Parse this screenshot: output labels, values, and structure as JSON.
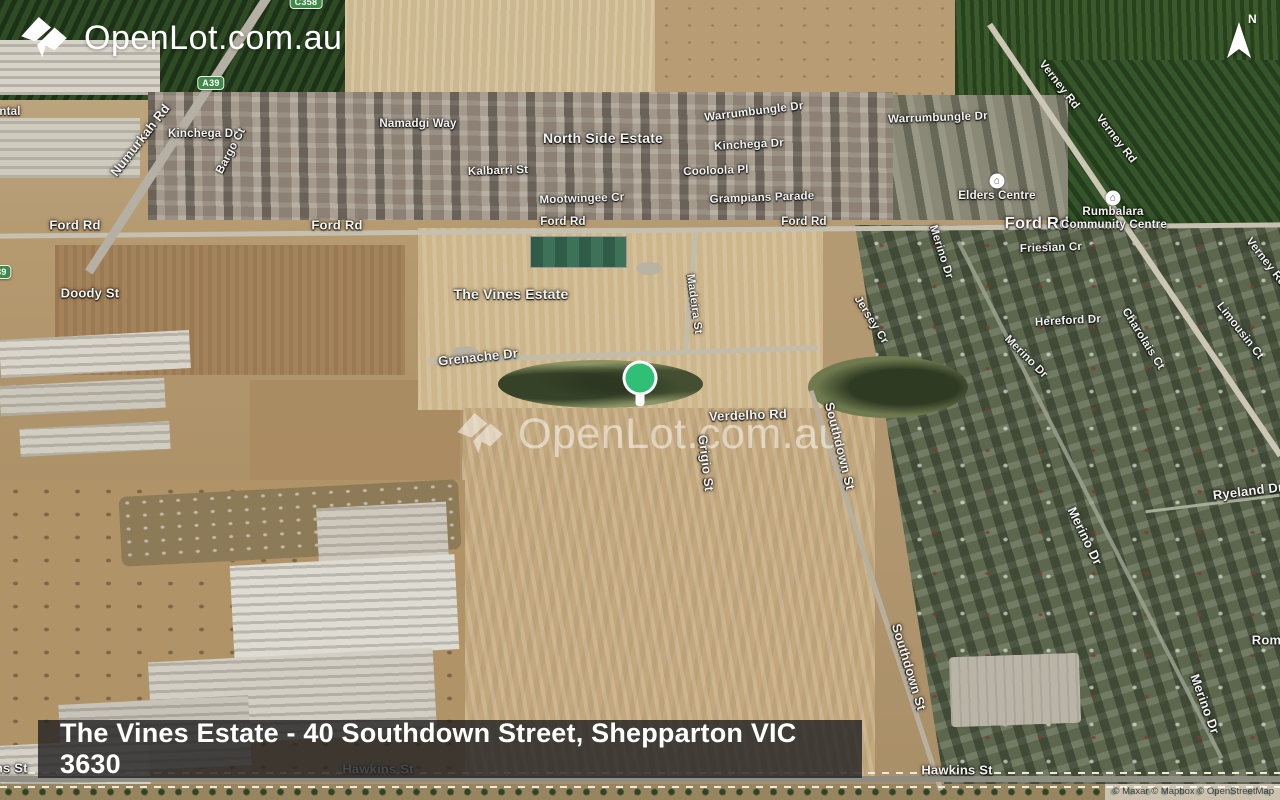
{
  "branding": {
    "logo_text": "OpenLot.com.au",
    "watermark_text": "OpenLot.com.au"
  },
  "compass": {
    "label": "N"
  },
  "pin": {
    "color": "#2fc076"
  },
  "title_bar": {
    "text": "The Vines Estate - 40 Southdown Street, Shepparton VIC 3630"
  },
  "attribution": {
    "text": "© Maxar © Mapbox © OpenStreetMap"
  },
  "colors": {
    "shield_green": "#3d8b47",
    "pin_green": "#2fc076",
    "bar_bg": "rgba(35,35,37,0.82)"
  },
  "map": {
    "shields": [
      {
        "text": "C358",
        "x": 306,
        "y": 2
      },
      {
        "text": "A39",
        "x": 211,
        "y": 83
      },
      {
        "text": "A39",
        "x": -2,
        "y": 272
      }
    ],
    "poi_icons": [
      {
        "name": "building-icon",
        "glyph": "⌂",
        "x": 997,
        "y": 181
      },
      {
        "name": "building-icon",
        "glyph": "⌂",
        "x": 1113,
        "y": 198
      }
    ],
    "labels": [
      {
        "text": "ntal",
        "x": 10,
        "y": 112,
        "rot": 0,
        "kind": "road"
      },
      {
        "text": "Numurkah Rd",
        "x": 140,
        "y": 140,
        "rot": -52,
        "kind": "road-lg"
      },
      {
        "text": "Kinchega Dr",
        "x": 203,
        "y": 134,
        "rot": 0,
        "kind": "road"
      },
      {
        "text": "Bargo Ct",
        "x": 231,
        "y": 151,
        "rot": -62,
        "kind": "road"
      },
      {
        "text": "Namadgi Way",
        "x": 418,
        "y": 124,
        "rot": 0,
        "kind": "road"
      },
      {
        "text": "North Side Estate",
        "x": 603,
        "y": 138,
        "rot": 0,
        "kind": "estate"
      },
      {
        "text": "Kalbarri St",
        "x": 498,
        "y": 171,
        "rot": -2,
        "kind": "road"
      },
      {
        "text": "Mootwingee Cr",
        "x": 582,
        "y": 199,
        "rot": -2,
        "kind": "road"
      },
      {
        "text": "Warrumbungle Dr",
        "x": 754,
        "y": 112,
        "rot": -7,
        "kind": "road"
      },
      {
        "text": "Kinchega Dr",
        "x": 749,
        "y": 145,
        "rot": -3,
        "kind": "road"
      },
      {
        "text": "Cooloola Pl",
        "x": 716,
        "y": 171,
        "rot": -2,
        "kind": "road"
      },
      {
        "text": "Grampians Parade",
        "x": 762,
        "y": 198,
        "rot": -2,
        "kind": "road"
      },
      {
        "text": "Warrumbungle Dr",
        "x": 938,
        "y": 118,
        "rot": -2,
        "kind": "road"
      },
      {
        "text": "Verney Rd",
        "x": 1059,
        "y": 85,
        "rot": 52,
        "kind": "road"
      },
      {
        "text": "Verney Rd",
        "x": 1116,
        "y": 139,
        "rot": 52,
        "kind": "road"
      },
      {
        "text": "Verney Rd",
        "x": 1266,
        "y": 262,
        "rot": 52,
        "kind": "road"
      },
      {
        "text": "Ford Rd",
        "x": 75,
        "y": 225,
        "rot": 0,
        "kind": "road-lg"
      },
      {
        "text": "Ford Rd",
        "x": 337,
        "y": 225,
        "rot": 0,
        "kind": "road-lg"
      },
      {
        "text": "Ford Rd",
        "x": 563,
        "y": 222,
        "rot": 0,
        "kind": "road"
      },
      {
        "text": "Ford Rd",
        "x": 804,
        "y": 222,
        "rot": 0,
        "kind": "road"
      },
      {
        "text": "Ford Rd",
        "x": 1037,
        "y": 224,
        "rot": 0,
        "kind": "road-xl"
      },
      {
        "text": "Elders Centre",
        "x": 997,
        "y": 196,
        "rot": 0,
        "kind": "poi"
      },
      {
        "text": "Rumbalara",
        "x": 1113,
        "y": 212,
        "rot": 0,
        "kind": "poi"
      },
      {
        "text": "Community Centre",
        "x": 1114,
        "y": 225,
        "rot": 0,
        "kind": "poi"
      },
      {
        "text": "Friesian Cr",
        "x": 1051,
        "y": 248,
        "rot": -2,
        "kind": "road"
      },
      {
        "text": "Doody St",
        "x": 90,
        "y": 293,
        "rot": 0,
        "kind": "road-lg"
      },
      {
        "text": "The Vines Estate",
        "x": 511,
        "y": 294,
        "rot": 0,
        "kind": "estate"
      },
      {
        "text": "Madeira St",
        "x": 694,
        "y": 304,
        "rot": 82,
        "kind": "road"
      },
      {
        "text": "Merino Dr",
        "x": 941,
        "y": 252,
        "rot": 72,
        "kind": "road"
      },
      {
        "text": "Jersey Cr",
        "x": 871,
        "y": 320,
        "rot": 58,
        "kind": "road"
      },
      {
        "text": "Hereford Dr",
        "x": 1068,
        "y": 321,
        "rot": -3,
        "kind": "road"
      },
      {
        "text": "Charolais Ct",
        "x": 1143,
        "y": 339,
        "rot": 58,
        "kind": "road"
      },
      {
        "text": "Limousin Ct",
        "x": 1240,
        "y": 331,
        "rot": 52,
        "kind": "road"
      },
      {
        "text": "Merino Dr",
        "x": 1026,
        "y": 357,
        "rot": 45,
        "kind": "road"
      },
      {
        "text": "Grenache Dr",
        "x": 478,
        "y": 357,
        "rot": -6,
        "kind": "road-lg"
      },
      {
        "text": "Verdelho Rd",
        "x": 748,
        "y": 415,
        "rot": -2,
        "kind": "road-lg"
      },
      {
        "text": "Grigio St",
        "x": 706,
        "y": 463,
        "rot": 83,
        "kind": "road-lg"
      },
      {
        "text": "Southdown St",
        "x": 840,
        "y": 446,
        "rot": 76,
        "kind": "road-lg"
      },
      {
        "text": "Ryeland Dr",
        "x": 1248,
        "y": 491,
        "rot": -7,
        "kind": "road-lg"
      },
      {
        "text": "Merino Dr",
        "x": 1085,
        "y": 536,
        "rot": 64,
        "kind": "road-lg"
      },
      {
        "text": "Romney",
        "x": 1278,
        "y": 640,
        "rot": 0,
        "kind": "road-lg"
      },
      {
        "text": "Southdown St",
        "x": 909,
        "y": 667,
        "rot": 73,
        "kind": "road-lg"
      },
      {
        "text": "Merino Dr",
        "x": 1205,
        "y": 704,
        "rot": 70,
        "kind": "road-lg"
      },
      {
        "text": "Hawkins St",
        "x": 378,
        "y": 769,
        "rot": 0,
        "kind": "road-lg"
      },
      {
        "text": "Hawkins St",
        "x": -8,
        "y": 768,
        "rot": 0,
        "kind": "road-lg"
      },
      {
        "text": "Hawkins St",
        "x": 957,
        "y": 770,
        "rot": 0,
        "kind": "road-lg"
      }
    ]
  }
}
